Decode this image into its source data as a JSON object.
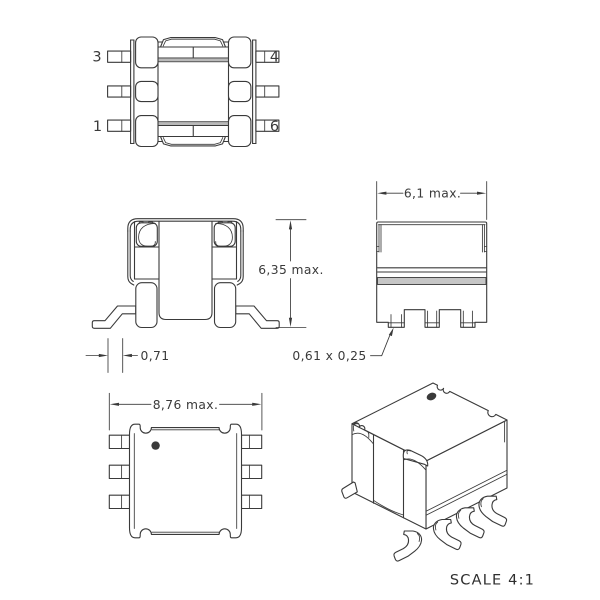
{
  "colors": {
    "line": "#3a3a3a",
    "background": "#ffffff",
    "band_gray": "#b9b9b9",
    "flange_gray": "#c6c6c6",
    "marker_dot": "#3a3a3a"
  },
  "views": {
    "top": {
      "pins": {
        "top_left": "3",
        "top_right": "4",
        "bottom_left": "1",
        "bottom_right": "6"
      }
    },
    "front": {
      "height_dim": "6,35 max.",
      "lead_dim": "0,71"
    },
    "side": {
      "width_dim": "6,1 max.",
      "lead_section_dim": "0,61 x 0,25"
    },
    "bottom": {
      "width_dim": "8,76 max."
    }
  },
  "footer": {
    "scale": "SCALE 4:1"
  }
}
